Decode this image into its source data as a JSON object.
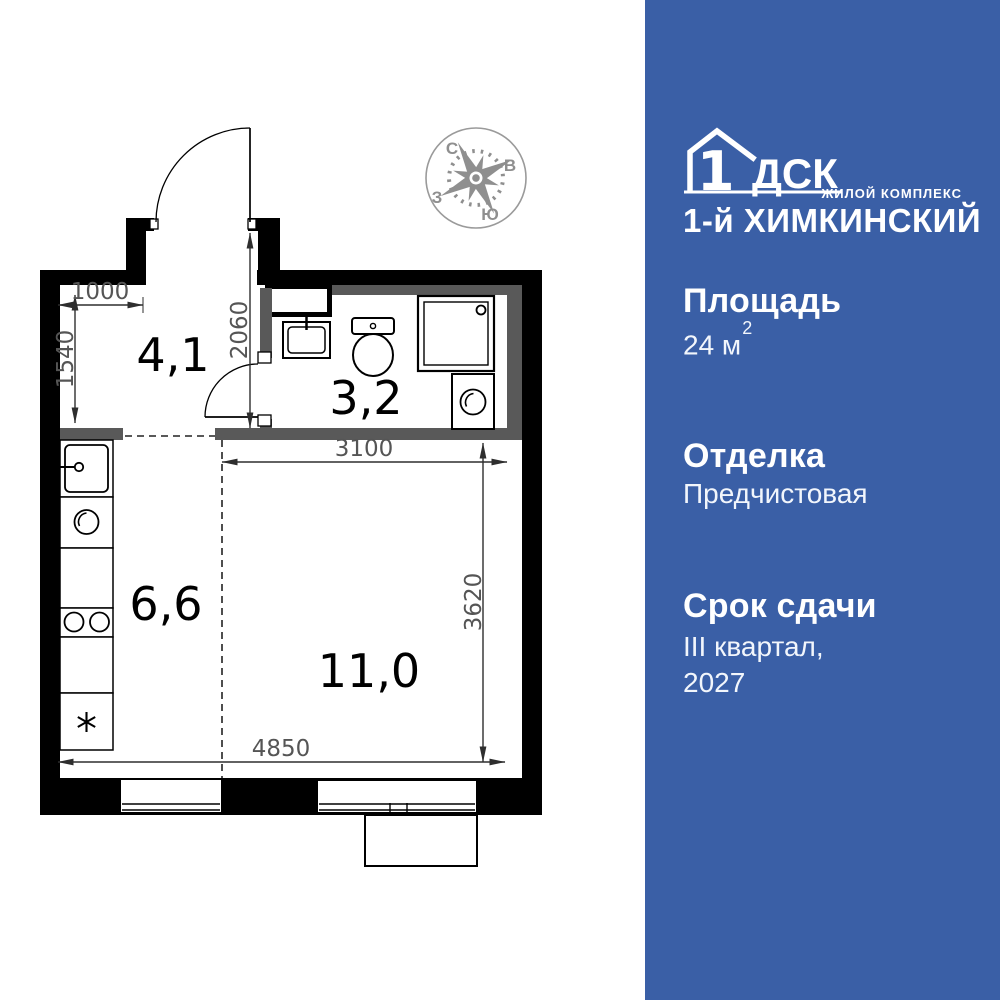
{
  "panel": {
    "brand": {
      "logo_number": "1",
      "logo_letters": "ДСК",
      "tagline": "ЖИЛОЙ КОМПЛЕКС",
      "complex_name": "1-й ХИМКИНСКИЙ"
    },
    "area": {
      "label": "Площадь",
      "value": "24 м",
      "sup": "2"
    },
    "finishing": {
      "label": "Отделка",
      "value": "Предчистовая"
    },
    "handover": {
      "label": "Срок сдачи",
      "quarter": "III квартал,",
      "year": "2027"
    }
  },
  "plan": {
    "rooms": [
      {
        "id": "hallway",
        "area": "4,1"
      },
      {
        "id": "bathroom",
        "area": "3,2"
      },
      {
        "id": "kitchen",
        "area": "6,6"
      },
      {
        "id": "living-room",
        "area": "11,0"
      }
    ],
    "dimensions": [
      {
        "id": "hallway-width",
        "label": "1000"
      },
      {
        "id": "hallway-depth",
        "label": "1540"
      },
      {
        "id": "entry-depth",
        "label": "2060"
      },
      {
        "id": "room-width",
        "label": "3100"
      },
      {
        "id": "room-depth",
        "label": "3620"
      },
      {
        "id": "apartment-width",
        "label": "4850"
      }
    ],
    "compass": {
      "north": "С",
      "east": "В",
      "west": "З",
      "south": "Ю"
    }
  },
  "colors": {
    "panel_blue": "#3a5fa6",
    "wall_black": "#000000",
    "partition_gray": "#595959",
    "dimension_line": "#2e2e2e",
    "dimension_text": "#555555",
    "compass_gray": "#8f8f8f"
  }
}
